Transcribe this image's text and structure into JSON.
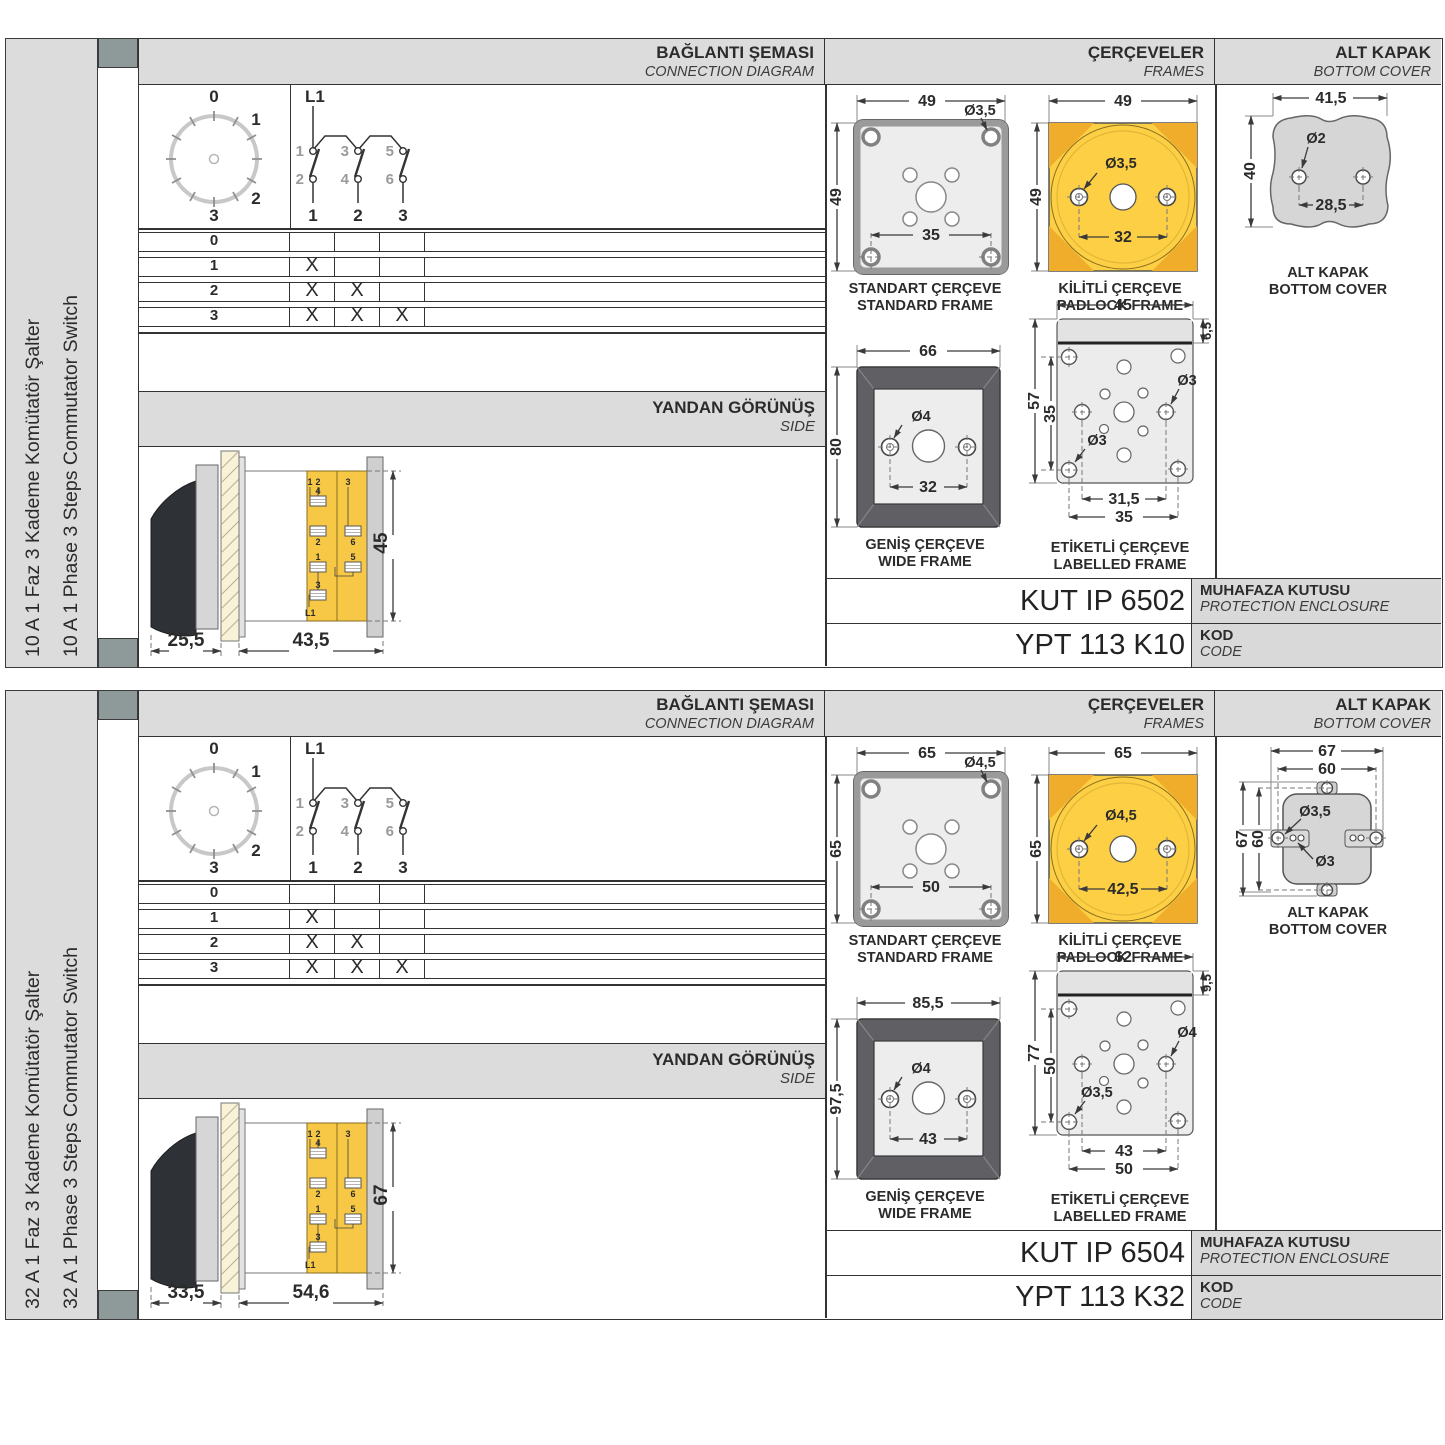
{
  "sections": [
    {
      "side_label_tr": "10 A 1 Faz 3 Kademe Komütatör Şalter",
      "side_label_en": "10 A 1 Phase 3 Steps Commutator Switch",
      "hdr": {
        "conn_t": "BAĞLANTI ŞEMASI",
        "conn_s": "CONNECTION DIAGRAM",
        "fr_t": "ÇERÇEVELER",
        "fr_s": "FRAMES",
        "cov_t": "ALT KAPAK",
        "cov_s": "BOTTOM COVER"
      },
      "dial": {
        "p0": "0",
        "p1": "1",
        "p2": "2",
        "p3": "3"
      },
      "circ": {
        "feed": "L1",
        "t1": "1",
        "t2": "2",
        "t3": "3",
        "t4": "4",
        "t5": "5",
        "t6": "6",
        "p1": "1",
        "p2": "2",
        "p3": "3"
      },
      "table": {
        "r0": {
          "l": "0",
          "c1": "",
          "c2": "",
          "c3": ""
        },
        "r1": {
          "l": "1",
          "c1": "X",
          "c2": "",
          "c3": ""
        },
        "r2": {
          "l": "2",
          "c1": "X",
          "c2": "X",
          "c3": ""
        },
        "r3": {
          "l": "3",
          "c1": "X",
          "c2": "X",
          "c3": "X"
        }
      },
      "side": {
        "t": "YANDAN GÖRÜNÜŞ",
        "s": "SIDE",
        "d_handle": "25,5",
        "d_body": "43,5",
        "d_height": "45",
        "m1": "1",
        "m2": "2",
        "m3": "3",
        "m4": "4",
        "m5": "2",
        "m6": "6",
        "m7": "1",
        "m8": "5",
        "m9": "3",
        "m10": "L1"
      },
      "std": {
        "w": "49",
        "h": "49",
        "hole": "Ø3,5",
        "pitch": "35",
        "t": "STANDART ÇERÇEVE",
        "s": "STANDARD FRAME"
      },
      "pad": {
        "w": "49",
        "h": "49",
        "hole": "Ø3,5",
        "pitch": "32",
        "t": "KİLİTLİ ÇERÇEVE",
        "s": "PADLOCK FRAME"
      },
      "wide": {
        "w": "66",
        "h": "80",
        "hole": "Ø4",
        "pitch": "32",
        "t": "GENİŞ ÇERÇEVE",
        "s": "WIDE FRAME"
      },
      "lab": {
        "w": "45",
        "strip": "6,5",
        "h": "57",
        "iv": "35",
        "p1": "31,5",
        "p2": "35",
        "h1": "Ø3",
        "h2": "Ø3",
        "t": "ETİKETLİ ÇERÇEVE",
        "s": "LABELLED FRAME"
      },
      "cov": {
        "w": "41,5",
        "h": "40",
        "pitch": "28,5",
        "hole": "Ø2",
        "t": "ALT KAPAK",
        "s": "BOTTOM COVER"
      },
      "codes": {
        "enclosure": "KUT IP 6502",
        "enc_t": "MUHAFAZA KUTUSU",
        "enc_s": "PROTECTION ENCLOSURE",
        "code": "YPT 113 K10",
        "kod_t": "KOD",
        "kod_s": "CODE"
      }
    },
    {
      "side_label_tr": "32 A 1 Faz 3 Kademe Komütatör Şalter",
      "side_label_en": "32 A 1 Phase 3 Steps Commutator Switch",
      "hdr": {
        "conn_t": "BAĞLANTI ŞEMASI",
        "conn_s": "CONNECTION DIAGRAM",
        "fr_t": "ÇERÇEVELER",
        "fr_s": "FRAMES",
        "cov_t": "ALT KAPAK",
        "cov_s": "BOTTOM COVER"
      },
      "dial": {
        "p0": "0",
        "p1": "1",
        "p2": "2",
        "p3": "3"
      },
      "circ": {
        "feed": "L1",
        "t1": "1",
        "t2": "2",
        "t3": "3",
        "t4": "4",
        "t5": "5",
        "t6": "6",
        "p1": "1",
        "p2": "2",
        "p3": "3"
      },
      "table": {
        "r0": {
          "l": "0",
          "c1": "",
          "c2": "",
          "c3": ""
        },
        "r1": {
          "l": "1",
          "c1": "X",
          "c2": "",
          "c3": ""
        },
        "r2": {
          "l": "2",
          "c1": "X",
          "c2": "X",
          "c3": ""
        },
        "r3": {
          "l": "3",
          "c1": "X",
          "c2": "X",
          "c3": "X"
        }
      },
      "side": {
        "t": "YANDAN GÖRÜNÜŞ",
        "s": "SIDE",
        "d_handle": "33,5",
        "d_body": "54,6",
        "d_height": "67",
        "m1": "1",
        "m2": "2",
        "m3": "3",
        "m4": "4",
        "m5": "2",
        "m6": "6",
        "m7": "1",
        "m8": "5",
        "m9": "3",
        "m10": "L1"
      },
      "std": {
        "w": "65",
        "h": "65",
        "hole": "Ø4,5",
        "pitch": "50",
        "t": "STANDART ÇERÇEVE",
        "s": "STANDARD FRAME"
      },
      "pad": {
        "w": "65",
        "h": "65",
        "hole": "Ø4,5",
        "pitch": "42,5",
        "t": "KİLİTLİ ÇERÇEVE",
        "s": "PADLOCK FRAME"
      },
      "wide": {
        "w": "85,5",
        "h": "97,5",
        "hole": "Ø4",
        "pitch": "43",
        "t": "GENİŞ ÇERÇEVE",
        "s": "WIDE FRAME"
      },
      "lab": {
        "w": "62",
        "strip": "9,5",
        "h": "77",
        "iv": "50",
        "p1": "43",
        "p2": "50",
        "h1": "Ø4",
        "h2": "Ø3,5",
        "t": "ETİKETLİ ÇERÇEVE",
        "s": "LABELLED FRAME"
      },
      "cov": {
        "w_out": "67",
        "w_in": "60",
        "h_out": "67",
        "h_in": "60",
        "hole1": "Ø3,5",
        "hole2": "Ø3",
        "t": "ALT KAPAK",
        "s": "BOTTOM COVER"
      },
      "codes": {
        "enclosure": "KUT IP 6504",
        "enc_t": "MUHAFAZA KUTUSU",
        "enc_s": "PROTECTION ENCLOSURE",
        "code": "YPT 113 K32",
        "kod_t": "KOD",
        "kod_s": "CODE"
      }
    }
  ]
}
